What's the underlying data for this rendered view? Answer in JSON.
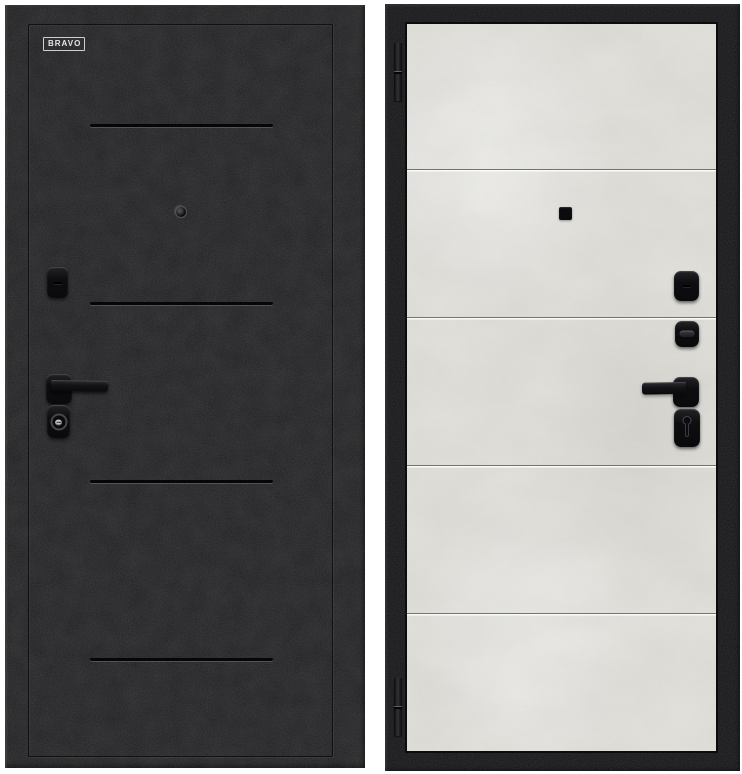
{
  "brand": {
    "label": "BRAVO"
  },
  "colors": {
    "page_bg": "#ffffff",
    "door_black": "#1c1c1e",
    "frame_black": "#141417",
    "panel_concrete": "#e4e3de",
    "seam_dark": "#72726e",
    "seam_light": "#fbfbf9",
    "groove_dark": "#060607",
    "hardware_black": "#131316",
    "logo_white": "#e6e6e6",
    "keyhole_light": "#c9c8c4"
  },
  "left_door": {
    "view": "exterior-side",
    "surface": "black-crinkle",
    "groove_count": 4,
    "hardware": [
      "peephole",
      "lock-cover",
      "lever-handle",
      "key-cylinder"
    ]
  },
  "right_door": {
    "view": "interior-side",
    "surface": "light-concrete",
    "seam_count": 4,
    "hinge_count": 2,
    "hardware": [
      "square-peephole",
      "lock-cover",
      "thumb-turn",
      "lever-handle",
      "keyhole-escutcheon"
    ]
  }
}
